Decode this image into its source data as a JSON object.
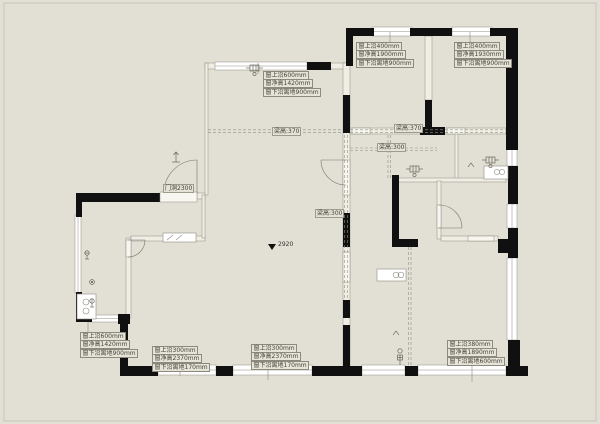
{
  "drawing": {
    "type": "floor-plan",
    "colors": {
      "background": "#e2e0d5",
      "wall": "#101010",
      "thin_wall_stroke": "#8f8c80",
      "window_fill": "#ffffff",
      "beam_dash": "#93907f",
      "annotation_text": "#45423a",
      "annotation_box": "#e6e4d8"
    }
  },
  "annotations": {
    "window_blocks": [
      {
        "id": "top-long-window",
        "lines": [
          "窗上沿600mm",
          "窗净高1420mm",
          "窗下沿离地900mm"
        ]
      },
      {
        "id": "top-window-a",
        "lines": [
          "窗上沿400mm",
          "窗净高1900mm",
          "窗下沿离地900mm"
        ]
      },
      {
        "id": "top-window-b",
        "lines": [
          "窗上沿400mm",
          "窗净高1930mm",
          "窗下沿离地900mm"
        ]
      },
      {
        "id": "left-step-window",
        "lines": [
          "窗上沿600mm",
          "窗净高1420mm",
          "窗下沿离地900mm"
        ]
      },
      {
        "id": "bottom-left-window",
        "lines": [
          "窗上沿300mm",
          "窗净高2370mm",
          "窗下沿离地170mm"
        ]
      },
      {
        "id": "bottom-center-window",
        "lines": [
          "窗上沿300mm",
          "窗净高2370mm",
          "窗下沿离地170mm"
        ]
      },
      {
        "id": "bottom-right-window",
        "lines": [
          "窗上沿380mm",
          "窗净高1890mm",
          "窗下沿离地600mm"
        ]
      }
    ],
    "beam_labels": [
      {
        "text": "梁高:370"
      },
      {
        "text": "梁高:370"
      },
      {
        "text": "梁高:300"
      },
      {
        "text": "梁高:300"
      }
    ],
    "door_label": {
      "text": "门洞2300"
    },
    "level_marker": {
      "text": "2920"
    }
  },
  "icons": {
    "heating_manifold": "manifold glyph cluster",
    "water_meter": "circle meter",
    "gas_meter": "circle meter",
    "floor_drain": "small circle",
    "vent_mark": "chevron",
    "entry_arrow": "small arrow",
    "level_marker": "down triangle"
  }
}
